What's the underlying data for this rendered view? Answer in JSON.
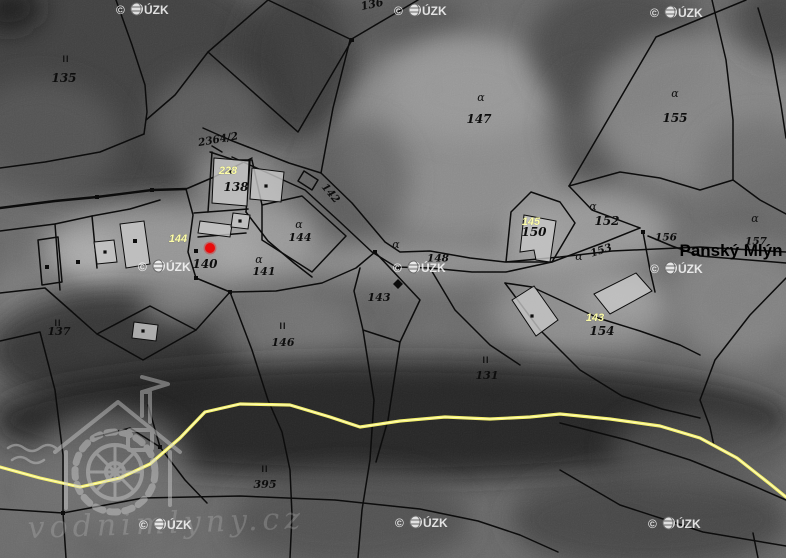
{
  "meta": {
    "title": "cadastral-orthophoto-map",
    "width": 786,
    "height": 558
  },
  "colors": {
    "boundary": "#0c0c0c",
    "building_fill": "#c7c7c7",
    "road_outer": "#f3ef6b",
    "road_core": "#fffdc8",
    "marker_red": "#e80c0c",
    "watermark": "rgba(250,250,250,0.85)",
    "label_black": "#0d0d0d",
    "label_yellow": "#fdfda8"
  },
  "watermark": {
    "copyright": "©",
    "org": "ÚZK",
    "full": "© ČÚZK",
    "positions": [
      [
        140,
        9
      ],
      [
        418,
        10
      ],
      [
        674,
        12
      ],
      [
        162,
        266
      ],
      [
        417,
        267
      ],
      [
        674,
        268
      ],
      [
        163,
        524
      ],
      [
        419,
        522
      ],
      [
        672,
        523
      ]
    ]
  },
  "logo": {
    "text": "vodnimlyny.cz"
  },
  "place_label": {
    "text": "Panský Mlýn",
    "x": 731,
    "y": 250,
    "size": 17
  },
  "marker": {
    "x": 210,
    "y": 248,
    "r": 5,
    "color": "#e80c0c"
  },
  "parcel_labels": [
    {
      "text": "135",
      "x": 64,
      "y": 78,
      "style": "num",
      "size": 12
    },
    {
      "text": "2364/2",
      "x": 218,
      "y": 139,
      "style": "num",
      "size": 10.5,
      "rot": -10
    },
    {
      "text": "228",
      "x": 228,
      "y": 170,
      "style": "yellow",
      "size": 11
    },
    {
      "text": "138",
      "x": 236,
      "y": 187,
      "style": "num",
      "size": 12
    },
    {
      "text": "144",
      "x": 178,
      "y": 238,
      "style": "yellow",
      "size": 11
    },
    {
      "text": "140",
      "x": 205,
      "y": 264,
      "style": "num",
      "size": 12
    },
    {
      "text": "141",
      "x": 264,
      "y": 271,
      "style": "num",
      "size": 11
    },
    {
      "text": "144",
      "x": 300,
      "y": 237,
      "style": "num",
      "size": 11
    },
    {
      "text": "142",
      "x": 331,
      "y": 193,
      "style": "num",
      "size": 10.5,
      "rot": 50
    },
    {
      "text": "147",
      "x": 479,
      "y": 119,
      "style": "num",
      "size": 12
    },
    {
      "text": "155",
      "x": 675,
      "y": 118,
      "style": "num",
      "size": 12
    },
    {
      "text": "136",
      "x": 372,
      "y": 4,
      "style": "num",
      "size": 11,
      "rot": -12
    },
    {
      "text": "148",
      "x": 438,
      "y": 258,
      "style": "num",
      "size": 10.5
    },
    {
      "text": "143",
      "x": 379,
      "y": 297,
      "style": "num",
      "size": 11
    },
    {
      "text": "145",
      "x": 531,
      "y": 221,
      "style": "yellow",
      "size": 11
    },
    {
      "text": "150",
      "x": 534,
      "y": 232,
      "style": "num",
      "size": 12
    },
    {
      "text": "152",
      "x": 607,
      "y": 221,
      "style": "num",
      "size": 12
    },
    {
      "text": "153",
      "x": 601,
      "y": 250,
      "style": "num",
      "size": 10.5,
      "rot": -18
    },
    {
      "text": "156",
      "x": 666,
      "y": 237,
      "style": "num",
      "size": 10.5
    },
    {
      "text": "157",
      "x": 756,
      "y": 241,
      "style": "num",
      "size": 10.5
    },
    {
      "text": "143",
      "x": 595,
      "y": 317,
      "style": "yellow",
      "size": 11
    },
    {
      "text": "154",
      "x": 602,
      "y": 331,
      "style": "num",
      "size": 12
    },
    {
      "text": "146",
      "x": 283,
      "y": 342,
      "style": "num",
      "size": 11
    },
    {
      "text": "137",
      "x": 59,
      "y": 331,
      "style": "num",
      "size": 11
    },
    {
      "text": "131",
      "x": 487,
      "y": 375,
      "style": "num",
      "size": 11
    },
    {
      "text": "395",
      "x": 265,
      "y": 484,
      "style": "num",
      "size": 11
    }
  ],
  "land_use_marks": [
    {
      "glyph": "II",
      "x": 66,
      "y": 59,
      "style": "mark",
      "size": 9
    },
    {
      "glyph": "II",
      "x": 58,
      "y": 323,
      "style": "mark",
      "size": 9
    },
    {
      "glyph": "II",
      "x": 283,
      "y": 326,
      "style": "mark",
      "size": 9
    },
    {
      "glyph": "II",
      "x": 486,
      "y": 360,
      "style": "mark",
      "size": 9
    },
    {
      "glyph": "II",
      "x": 265,
      "y": 469,
      "style": "mark",
      "size": 9
    },
    {
      "glyph": "ɑ",
      "x": 481,
      "y": 97,
      "style": "grass",
      "size": 11
    },
    {
      "glyph": "ɑ",
      "x": 675,
      "y": 93,
      "style": "grass",
      "size": 11
    },
    {
      "glyph": "ɑ",
      "x": 299,
      "y": 224,
      "style": "grass",
      "size": 11
    },
    {
      "glyph": "ɑ",
      "x": 259,
      "y": 259,
      "style": "grass",
      "size": 11
    },
    {
      "glyph": "ɑ",
      "x": 396,
      "y": 244,
      "style": "grass",
      "size": 11
    },
    {
      "glyph": "ɑ",
      "x": 593,
      "y": 206,
      "style": "grass",
      "size": 11
    },
    {
      "glyph": "ɑ",
      "x": 579,
      "y": 256,
      "style": "grass",
      "size": 11
    },
    {
      "glyph": "ɑ",
      "x": 755,
      "y": 218,
      "style": "grass",
      "size": 11
    }
  ],
  "geometry": {
    "texture_blobs": [
      {
        "cx": 120,
        "cy": 80,
        "rx": 170,
        "ry": 120,
        "fill": "#3c3c3c",
        "op": 0.9
      },
      {
        "cx": 8,
        "cy": 8,
        "rx": 34,
        "ry": 24,
        "fill": "#141414",
        "op": 0.8
      },
      {
        "cx": 40,
        "cy": 140,
        "rx": 80,
        "ry": 60,
        "fill": "#585858",
        "op": 0.8
      },
      {
        "cx": 300,
        "cy": 60,
        "rx": 60,
        "ry": 80,
        "fill": "#383838",
        "op": 0.85
      },
      {
        "cx": 400,
        "cy": 20,
        "rx": 70,
        "ry": 30,
        "fill": "#4f4f4f",
        "op": 0.7
      },
      {
        "cx": 460,
        "cy": 140,
        "rx": 120,
        "ry": 100,
        "fill": "#8f8f8f",
        "op": 0.9
      },
      {
        "cx": 470,
        "cy": 90,
        "rx": 80,
        "ry": 50,
        "fill": "#9a9a9a",
        "op": 0.8
      },
      {
        "cx": 620,
        "cy": 50,
        "rx": 90,
        "ry": 70,
        "fill": "#474747",
        "op": 0.85
      },
      {
        "cx": 590,
        "cy": 130,
        "rx": 40,
        "ry": 60,
        "fill": "#4a4a4a",
        "op": 0.7
      },
      {
        "cx": 700,
        "cy": 110,
        "rx": 110,
        "ry": 80,
        "fill": "#8a8a8a",
        "op": 0.85
      },
      {
        "cx": 775,
        "cy": 20,
        "rx": 40,
        "ry": 40,
        "fill": "#3a3a3a",
        "op": 0.7
      },
      {
        "cx": 760,
        "cy": 170,
        "rx": 60,
        "ry": 50,
        "fill": "#6a6a6a",
        "op": 0.7
      },
      {
        "cx": 210,
        "cy": 120,
        "rx": 60,
        "ry": 50,
        "fill": "#6f6f6f",
        "op": 0.6
      },
      {
        "cx": 235,
        "cy": 180,
        "rx": 45,
        "ry": 35,
        "fill": "#8f8f8f",
        "op": 0.8
      },
      {
        "cx": 150,
        "cy": 250,
        "rx": 110,
        "ry": 45,
        "fill": "#9a9a9a",
        "op": 0.9
      },
      {
        "cx": 90,
        "cy": 255,
        "rx": 35,
        "ry": 20,
        "fill": "#b2b2b2",
        "op": 0.8
      },
      {
        "cx": 260,
        "cy": 240,
        "rx": 60,
        "ry": 40,
        "fill": "#a8a8a8",
        "op": 0.75
      },
      {
        "cx": 360,
        "cy": 180,
        "rx": 50,
        "ry": 60,
        "fill": "#555555",
        "op": 0.6
      },
      {
        "cx": 450,
        "cy": 262,
        "rx": 160,
        "ry": 18,
        "fill": "#9c9c9c",
        "op": 0.8
      },
      {
        "cx": 540,
        "cy": 240,
        "rx": 30,
        "ry": 25,
        "fill": "#b0b0b0",
        "op": 0.7
      },
      {
        "cx": 590,
        "cy": 230,
        "rx": 80,
        "ry": 40,
        "fill": "#a0a0a0",
        "op": 0.85
      },
      {
        "cx": 580,
        "cy": 310,
        "rx": 90,
        "ry": 45,
        "fill": "#959595",
        "op": 0.8
      },
      {
        "cx": 620,
        "cy": 300,
        "rx": 40,
        "ry": 20,
        "fill": "#a5a5a5",
        "op": 0.7
      },
      {
        "cx": 740,
        "cy": 300,
        "rx": 70,
        "ry": 60,
        "fill": "#8b8b8b",
        "op": 0.7
      },
      {
        "cx": 30,
        "cy": 300,
        "rx": 40,
        "ry": 40,
        "fill": "#888888",
        "op": 0.6
      },
      {
        "cx": 120,
        "cy": 350,
        "rx": 130,
        "ry": 60,
        "fill": "#2b2b2b",
        "op": 0.8
      },
      {
        "cx": 280,
        "cy": 330,
        "rx": 70,
        "ry": 40,
        "fill": "#777777",
        "op": 0.6
      },
      {
        "cx": 180,
        "cy": 300,
        "rx": 40,
        "ry": 25,
        "fill": "#8f8f8f",
        "op": 0.7
      },
      {
        "cx": 390,
        "cy": 420,
        "rx": 400,
        "ry": 60,
        "fill": "#1f1f1f",
        "op": 0.85
      },
      {
        "cx": 110,
        "cy": 470,
        "rx": 80,
        "ry": 60,
        "fill": "#6f6f6f",
        "op": 0.8
      },
      {
        "cx": 350,
        "cy": 520,
        "rx": 120,
        "ry": 50,
        "fill": "#4e4e4e",
        "op": 0.8
      },
      {
        "cx": 650,
        "cy": 520,
        "rx": 140,
        "ry": 50,
        "fill": "#3f3f3f",
        "op": 0.8
      },
      {
        "cx": 700,
        "cy": 450,
        "rx": 90,
        "ry": 40,
        "fill": "#555555",
        "op": 0.7
      }
    ],
    "boundaries": [
      {
        "p": "116,0 132,45 145,85 147,112 144,134"
      },
      {
        "p": "144,134 100,152 45,162 0,168"
      },
      {
        "p": "0,208 55,201 97,197 152,190 186,189",
        "w": 2.4
      },
      {
        "p": "268,0 352,40 298,132 208,52 268,0"
      },
      {
        "p": "418,0 350,40"
      },
      {
        "p": "350,40 333,108 321,173"
      },
      {
        "p": "208,52 175,95 146,120"
      },
      {
        "p": "203,128 230,140 248,147"
      },
      {
        "p": "210,152 234,160 252,160"
      },
      {
        "p": "248,147 289,163 321,173 352,203 385,242 400,252 430,251 470,258 505,262 560,257 612,251 656,249 700,247 786,252"
      },
      {
        "p": "232,157 270,174 305,190 340,222 372,252 396,267 430,268 472,272 506,272 552,262"
      },
      {
        "p": "552,262 600,244 640,228"
      },
      {
        "p": "648,236 672,246 700,256 786,263"
      },
      {
        "p": "304,171 318,180 312,190 298,181 304,171"
      },
      {
        "p": "186,189 214,177 236,166 252,158"
      },
      {
        "p": "186,189 193,215 188,252 196,278"
      },
      {
        "p": "196,278 230,292 276,291 322,283 356,268 375,252"
      },
      {
        "p": "212,152 208,212"
      },
      {
        "p": "250,160 246,212"
      },
      {
        "p": "194,213 248,209"
      },
      {
        "p": "198,237 246,233"
      },
      {
        "p": "246,212 268,241 294,263 312,277"
      },
      {
        "p": "252,160 262,205"
      },
      {
        "p": "262,205 302,196 346,236 312,272 262,240 262,205"
      },
      {
        "p": "0,231 55,224 92,216 130,209 160,200"
      },
      {
        "p": "55,224 60,290"
      },
      {
        "p": "92,216 97,268"
      },
      {
        "p": "38,240 58,237 62,282 42,285 38,240"
      },
      {
        "p": "0,293 45,288 70,310 97,334"
      },
      {
        "p": "97,334 150,306 196,330 143,360 97,334"
      },
      {
        "p": "196,330 230,292"
      },
      {
        "p": "0,341 40,332 55,390 63,455 63,513"
      },
      {
        "p": "230,292 252,350 268,400 282,432 290,470 292,515 290,558"
      },
      {
        "p": "375,252 420,300 400,342 363,330 354,291 360,268"
      },
      {
        "p": "363,330 374,400 370,460 362,510 358,558"
      },
      {
        "p": "400,342 388,420 376,462"
      },
      {
        "p": "0,509 63,513 143,498 240,496 335,500 420,509 478,521 520,535 558,552"
      },
      {
        "p": "63,513 66,558"
      },
      {
        "p": "95,437 130,428 160,447 185,480 207,503"
      },
      {
        "p": "160,447 148,405"
      },
      {
        "p": "560,423 627,440 690,460 747,483 786,500"
      },
      {
        "p": "560,470 620,505 703,532 786,546"
      },
      {
        "p": "786,278 750,315 715,360 700,400 710,427 714,446"
      },
      {
        "p": "753,533 758,558"
      },
      {
        "p": "746,0 656,37 586,157 569,186"
      },
      {
        "p": "569,186 592,210 640,228"
      },
      {
        "p": "569,186 620,172 660,178 700,190 733,180"
      },
      {
        "p": "712,0 726,60 733,120 733,180 760,200 786,214"
      },
      {
        "p": "758,8 772,55 781,105 786,138"
      },
      {
        "p": "531,192 560,202 575,223 552,262 506,262 511,212 531,192"
      },
      {
        "p": "505,283 532,287 560,300 598,318 640,331 680,345 700,355"
      },
      {
        "p": "505,283 540,330 580,370 622,396 662,409 700,418"
      },
      {
        "p": "643,232 650,270 655,292"
      },
      {
        "p": "430,268 455,310 490,345 520,365"
      },
      {
        "p": "212,146 222,152"
      }
    ],
    "buildings": [
      {
        "p": "214,158 249,161 247,206 212,203",
        "dot": [
          231,
          172
        ]
      },
      {
        "p": "252,168 284,172 281,202 250,199",
        "dot": [
          266,
          186
        ]
      },
      {
        "p": "120,224 144,221 150,264 126,268",
        "dot": null
      },
      {
        "p": "94,242 114,240 117,262 97,264",
        "dot": [
          105,
          252
        ]
      },
      {
        "p": "200,221 232,225 230,237 198,233",
        "dot": null
      },
      {
        "p": "233,213 250,215 248,229 231,227",
        "dot": [
          240,
          221
        ]
      },
      {
        "p": "524,215 556,221 550,262 536,260 534,250 520,252",
        "dot": null
      },
      {
        "p": "594,294 636,273 652,291 610,314",
        "dot": null
      },
      {
        "p": "512,300 534,286 558,320 536,336",
        "dot": [
          532,
          316
        ]
      },
      {
        "p": "134,322 158,325 156,341 132,338",
        "dot": [
          143,
          331
        ]
      }
    ],
    "vertex_dots": [
      [
        97,
        197
      ],
      [
        152,
        190
      ],
      [
        352,
        40
      ],
      [
        160,
        447
      ],
      [
        63,
        513
      ],
      [
        375,
        252
      ],
      [
        398,
        268
      ],
      [
        196,
        278
      ],
      [
        230,
        292
      ],
      [
        643,
        232
      ],
      [
        47,
        267
      ],
      [
        78,
        262
      ],
      [
        135,
        241
      ],
      [
        196,
        251
      ]
    ],
    "diamond_marker": "398,279 403,284 398,289 393,284",
    "road": {
      "p": "0,467 40,478 80,487 120,478 150,464 180,438 205,412 240,404 290,405 330,417 360,427 400,421 445,417 490,419 530,417 560,414 610,419 660,426 700,438 737,458 770,484 786,497"
    }
  }
}
